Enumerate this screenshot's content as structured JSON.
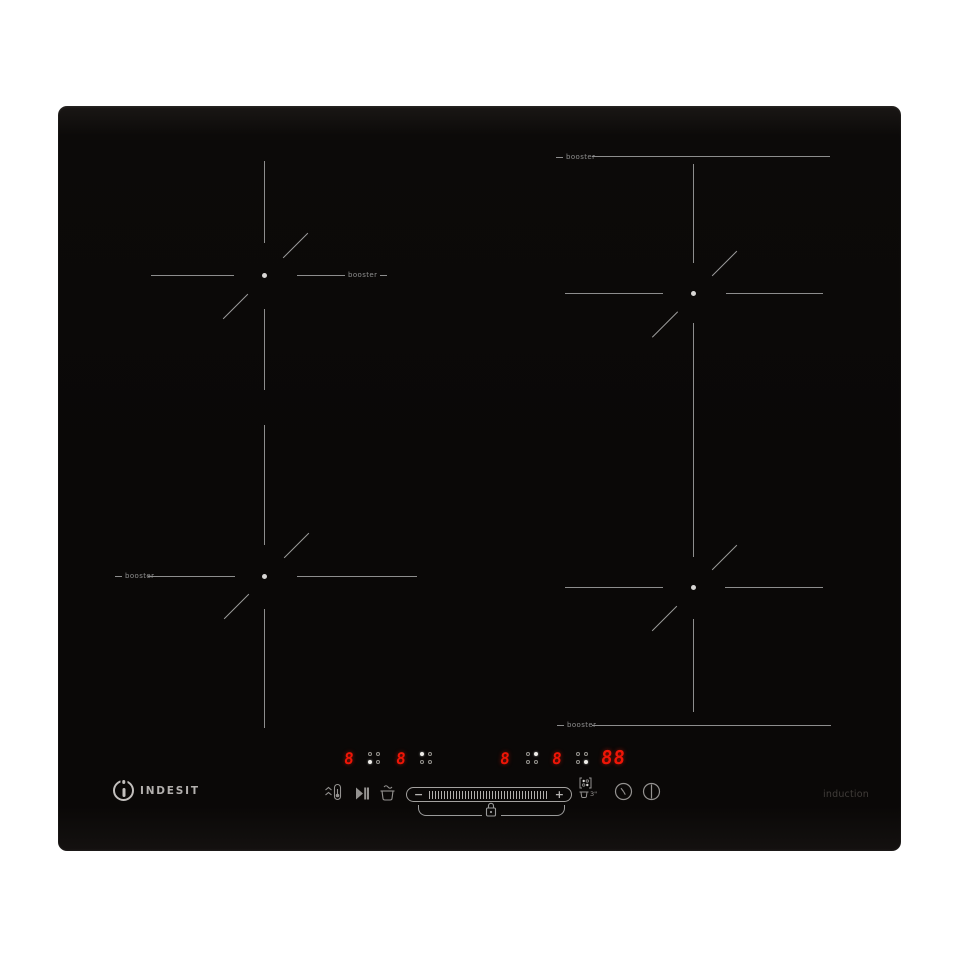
{
  "brand": {
    "mark_letter": "i",
    "wordmark": "INDESIT"
  },
  "surface": {
    "type_label": "induction"
  },
  "zones": {
    "top_left": {
      "booster": "booster"
    },
    "top_right": {
      "booster": "booster"
    },
    "bottom_left": {
      "booster": "booster"
    },
    "bottom_right": {
      "booster": "booster"
    }
  },
  "display": {
    "zones": [
      {
        "power": "8",
        "position": "bottom-left"
      },
      {
        "power": "8",
        "position": "top-left"
      },
      {
        "power": "8",
        "position": "top-right"
      },
      {
        "power": "8",
        "position": "bottom-right"
      }
    ],
    "timer": "88"
  },
  "controls": {
    "minus": "−",
    "plus": "+",
    "pan_min_size": "3\""
  },
  "colors": {
    "led": "#ee1506",
    "marking": "#8f8f8f",
    "surface": "#0b0908"
  }
}
